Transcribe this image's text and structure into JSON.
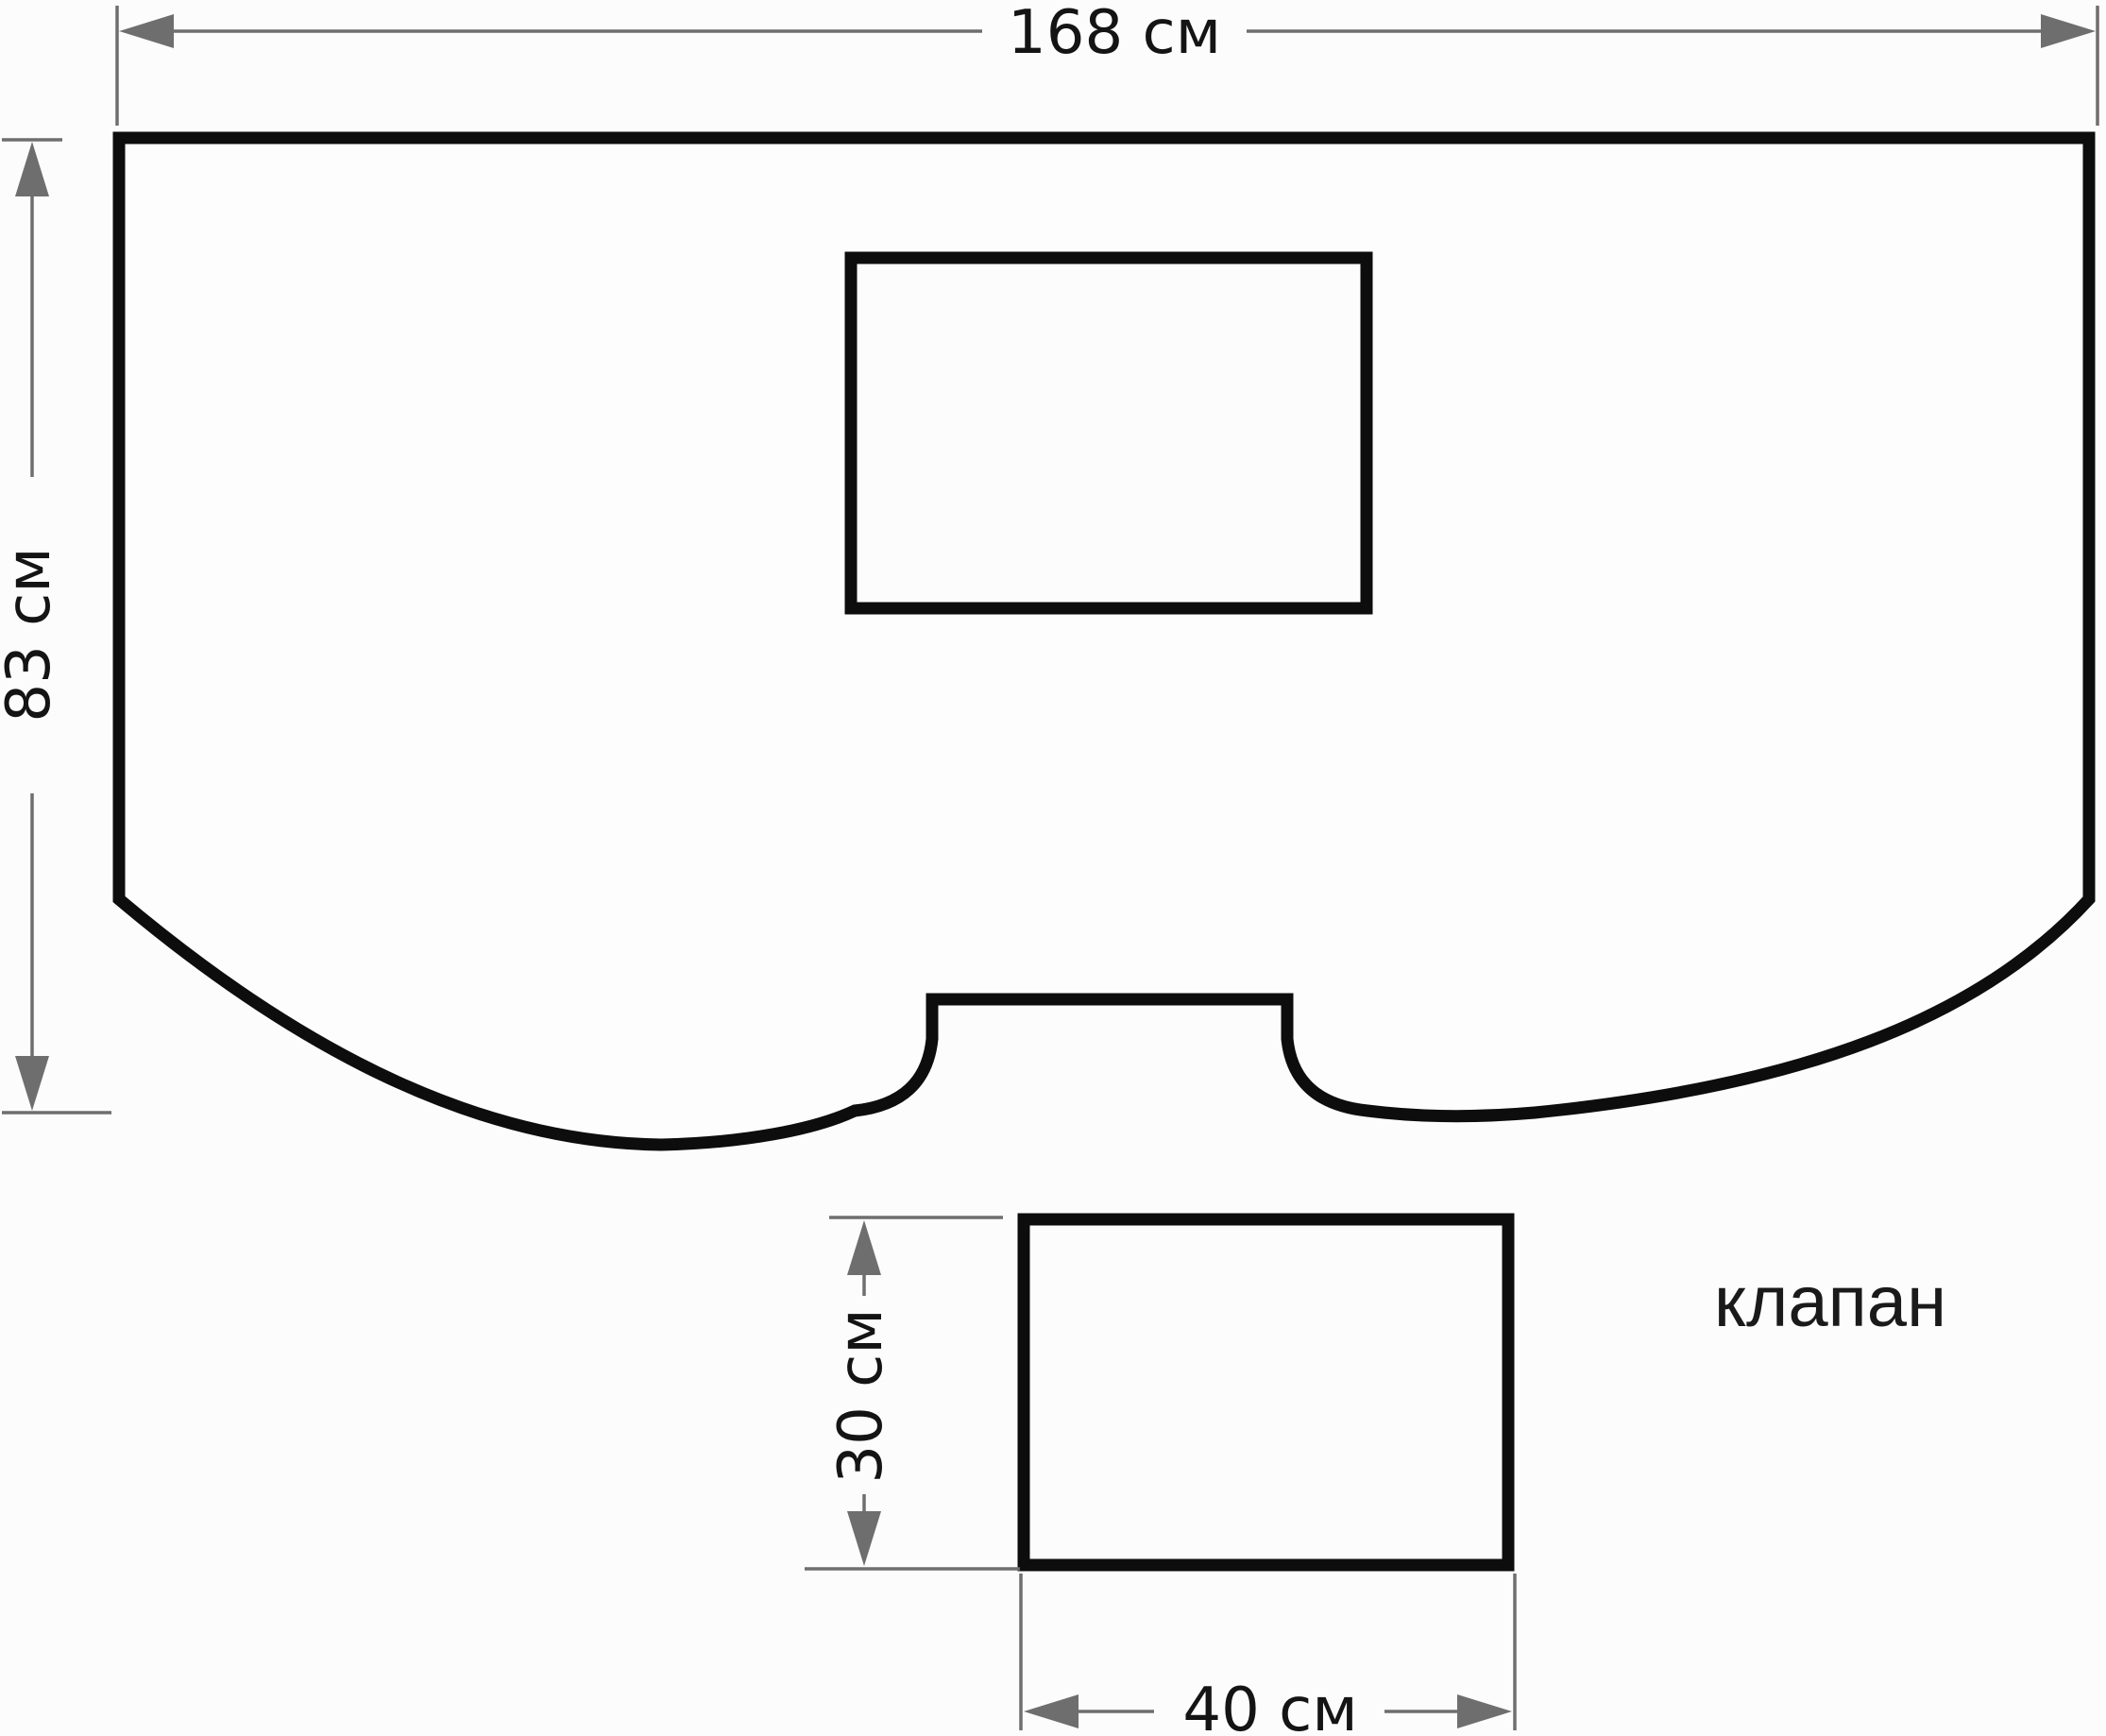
{
  "diagram": {
    "labels": {
      "flap_caption": "клапан"
    },
    "dims": {
      "main_width": "168 см",
      "main_height": "83 см",
      "flap_height": "30 см",
      "flap_width": "40 см"
    },
    "values_cm": {
      "main_width": 168,
      "main_height": 83,
      "flap_width": 40,
      "flap_height": 30
    },
    "colors": {
      "outline": "#0d0d0d",
      "dimension_gray": "#6e6e6e",
      "text_black": "#141414",
      "background": "#fcfcfc"
    }
  }
}
